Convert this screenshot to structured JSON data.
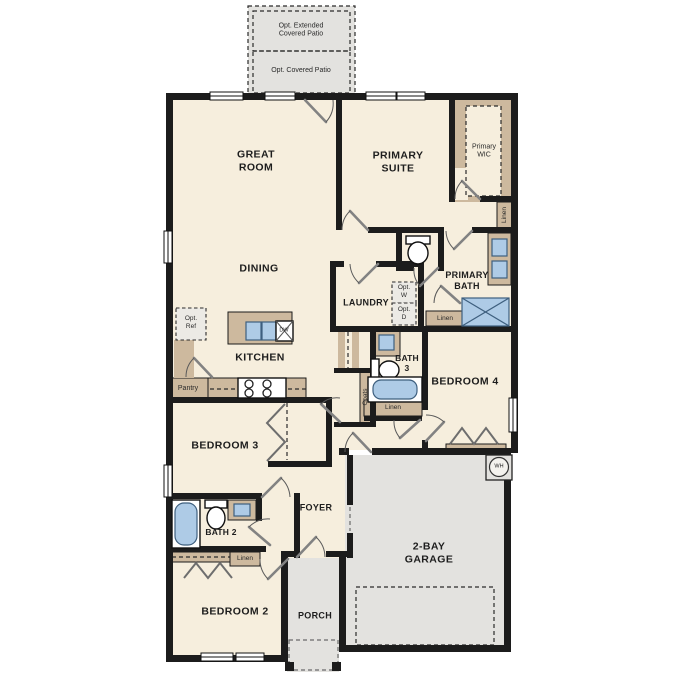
{
  "floorplan": {
    "options": {
      "extended_patio": "Opt. Extended\nCovered Patio",
      "covered_patio": "Opt. Covered Patio",
      "refrigerator": "Opt.\nRef",
      "washer": "Opt.\nW",
      "dryer": "Opt.\nD"
    },
    "rooms": {
      "great_room": "GREAT\nROOM",
      "dining": "DINING",
      "kitchen": "KITCHEN",
      "primary_suite": "PRIMARY\nSUITE",
      "primary_wic": "Primary\nWIC",
      "primary_bath": "PRIMARY\nBATH",
      "laundry": "LAUNDRY",
      "bath_3": "BATH\n3",
      "bedroom_4": "BEDROOM 4",
      "bedroom_3": "BEDROOM 3",
      "bath_2": "BATH 2",
      "foyer": "FOYER",
      "bedroom_2": "BEDROOM 2",
      "porch": "PORCH",
      "garage": "2-BAY\nGARAGE"
    },
    "closets": {
      "pantry": "Pantry",
      "coats": "Coats",
      "linen_primary": "Linen",
      "linen_bath_hall": "Linen",
      "linen_bath_3": "Linen",
      "linen_bath_2": "Linen"
    },
    "equipment": {
      "dishwasher": "DW",
      "water_heater": "WH"
    },
    "colors": {
      "floor": "#f6eedd",
      "hardscape": "#e3e2df",
      "casework": "#cdb99e",
      "fixture": "#aecbe6",
      "wall": "#1c1c1c"
    }
  }
}
